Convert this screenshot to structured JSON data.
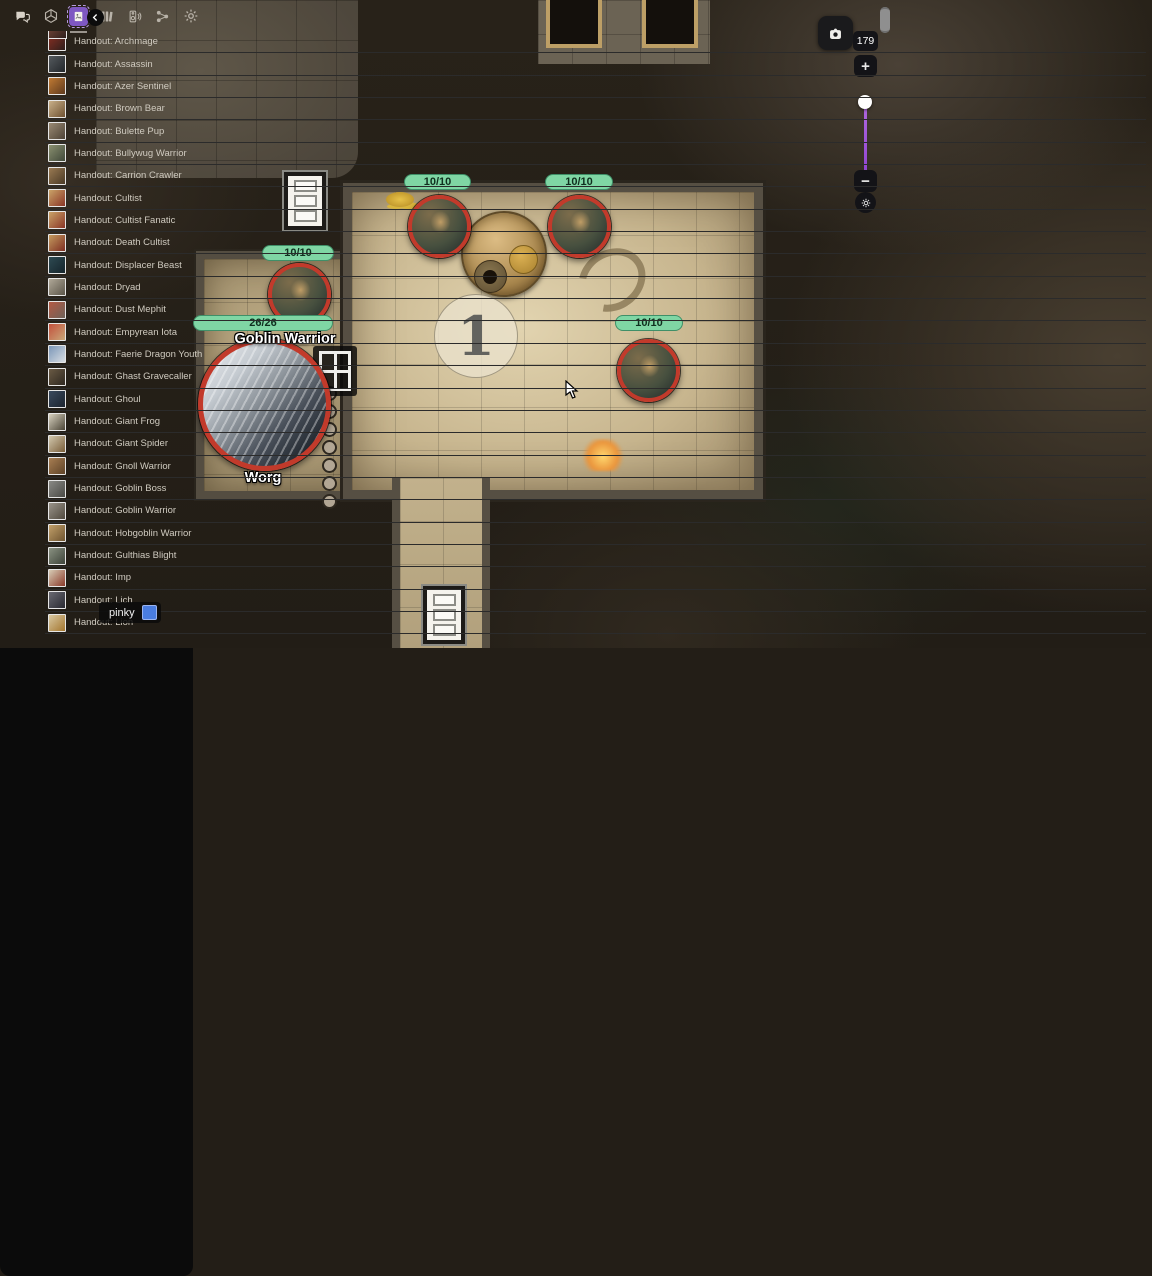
{
  "left_toolbar": {
    "tools_label": "TOOLS",
    "fx_label": "FX",
    "layers_label": "LAYERS",
    "tool_icons": [
      "menu",
      "play",
      "pan-hand",
      "draw",
      "text",
      "ruler",
      "shapes",
      "notes",
      "fog",
      "pointer",
      "light-fx",
      "effects"
    ],
    "selected_tool": "play",
    "layers": [
      {
        "label": "TOKENS",
        "selected": true
      },
      {
        "label": "GM",
        "selected": false
      },
      {
        "label": "MAP",
        "selected": false
      },
      {
        "label": "FORE",
        "selected": false
      },
      {
        "label": "LIGHT",
        "selected": false
      }
    ],
    "tokens_accent_color": "#2e8f86"
  },
  "top_toolbar": {
    "icons": [
      "chat",
      "dice",
      "handouts",
      "library",
      "audio",
      "share",
      "settings"
    ],
    "selected": "handouts",
    "selected_color": "#7e57c2"
  },
  "zoom_controls": {
    "zoom_percent": "179",
    "zoom_in": "+",
    "zoom_out": "−"
  },
  "user_badge": {
    "name": "pinky",
    "color": "#4a7de0"
  },
  "map": {
    "room_marker": "1",
    "hp_color": "#7fd6a4",
    "ring_color": "#c23a2b",
    "tokens": [
      {
        "id": "goblin-1",
        "hp": "10/10"
      },
      {
        "id": "goblin-2",
        "hp": "10/10"
      },
      {
        "id": "goblin-3",
        "hp": "10/10",
        "label": "Goblin Warrior"
      },
      {
        "id": "goblin-4",
        "hp": "10/10"
      },
      {
        "id": "worg",
        "hp": "26/26",
        "label": "Worg"
      }
    ]
  },
  "sidebar": {
    "items": [
      {
        "label": "Handout: Archmage",
        "thumb": [
          "#8a2f23",
          "#2e1f1c"
        ]
      },
      {
        "label": "Handout: Assassin",
        "thumb": [
          "#555a5e",
          "#23272b"
        ]
      },
      {
        "label": "Handout: Azer Sentinel",
        "thumb": [
          "#c07a33",
          "#5e3a1e"
        ]
      },
      {
        "label": "Handout: Brown Bear",
        "thumb": [
          "#c9b089",
          "#6e5132"
        ]
      },
      {
        "label": "Handout: Bulette Pup",
        "thumb": [
          "#9a8a74",
          "#4e4336"
        ]
      },
      {
        "label": "Handout: Bullywug Warrior",
        "thumb": [
          "#8a9070",
          "#41493a"
        ]
      },
      {
        "label": "Handout: Carrion Crawler",
        "thumb": [
          "#9a7a52",
          "#4a3a26"
        ]
      },
      {
        "label": "Handout: Cultist",
        "thumb": [
          "#caa368",
          "#8a3526"
        ]
      },
      {
        "label": "Handout: Cultist Fanatic",
        "thumb": [
          "#caa368",
          "#8a3526"
        ]
      },
      {
        "label": "Handout: Death Cultist",
        "thumb": [
          "#c49a5e",
          "#7e2e22"
        ]
      },
      {
        "label": "Handout: Displacer Beast",
        "thumb": [
          "#2e4a52",
          "#15242b"
        ]
      },
      {
        "label": "Handout: Dryad",
        "thumb": [
          "#b0a898",
          "#5c564a"
        ]
      },
      {
        "label": "Handout: Dust Mephit",
        "thumb": [
          "#b45a44",
          "#6e6258"
        ]
      },
      {
        "label": "Handout: Empyrean Iota",
        "thumb": [
          "#c2503c",
          "#caa87a"
        ]
      },
      {
        "label": "Handout: Faerie Dragon Youth",
        "thumb": [
          "#7a96b8",
          "#d8dde2"
        ]
      },
      {
        "label": "Handout: Ghast Gravecaller",
        "thumb": [
          "#6a5a44",
          "#2e2820"
        ]
      },
      {
        "label": "Handout: Ghoul",
        "thumb": [
          "#3a4a5e",
          "#1c242e"
        ]
      },
      {
        "label": "Handout: Giant Frog",
        "thumb": [
          "#d8d2c0",
          "#4a4436"
        ]
      },
      {
        "label": "Handout: Giant Spider",
        "thumb": [
          "#d2c8ae",
          "#7a5e3a"
        ]
      },
      {
        "label": "Handout: Gnoll Warrior",
        "thumb": [
          "#a87e52",
          "#5e4328"
        ]
      },
      {
        "label": "Handout: Goblin Boss",
        "thumb": [
          "#8a8a86",
          "#4a4a46"
        ]
      },
      {
        "label": "Handout: Goblin Warrior",
        "thumb": [
          "#9a948a",
          "#50493e"
        ]
      },
      {
        "label": "Handout: Hobgoblin Warrior",
        "thumb": [
          "#c2a06a",
          "#6e5430"
        ]
      },
      {
        "label": "Handout: Gulthias Blight",
        "thumb": [
          "#8a9282",
          "#3e443a"
        ]
      },
      {
        "label": "Handout: Imp",
        "thumb": [
          "#d8cdb6",
          "#8a3a2a"
        ]
      },
      {
        "label": "Handout: Lich",
        "thumb": [
          "#6a6a72",
          "#2a2a32"
        ]
      },
      {
        "label": "Handout: Lion",
        "thumb": [
          "#d8c8a2",
          "#a4762e"
        ]
      }
    ]
  }
}
